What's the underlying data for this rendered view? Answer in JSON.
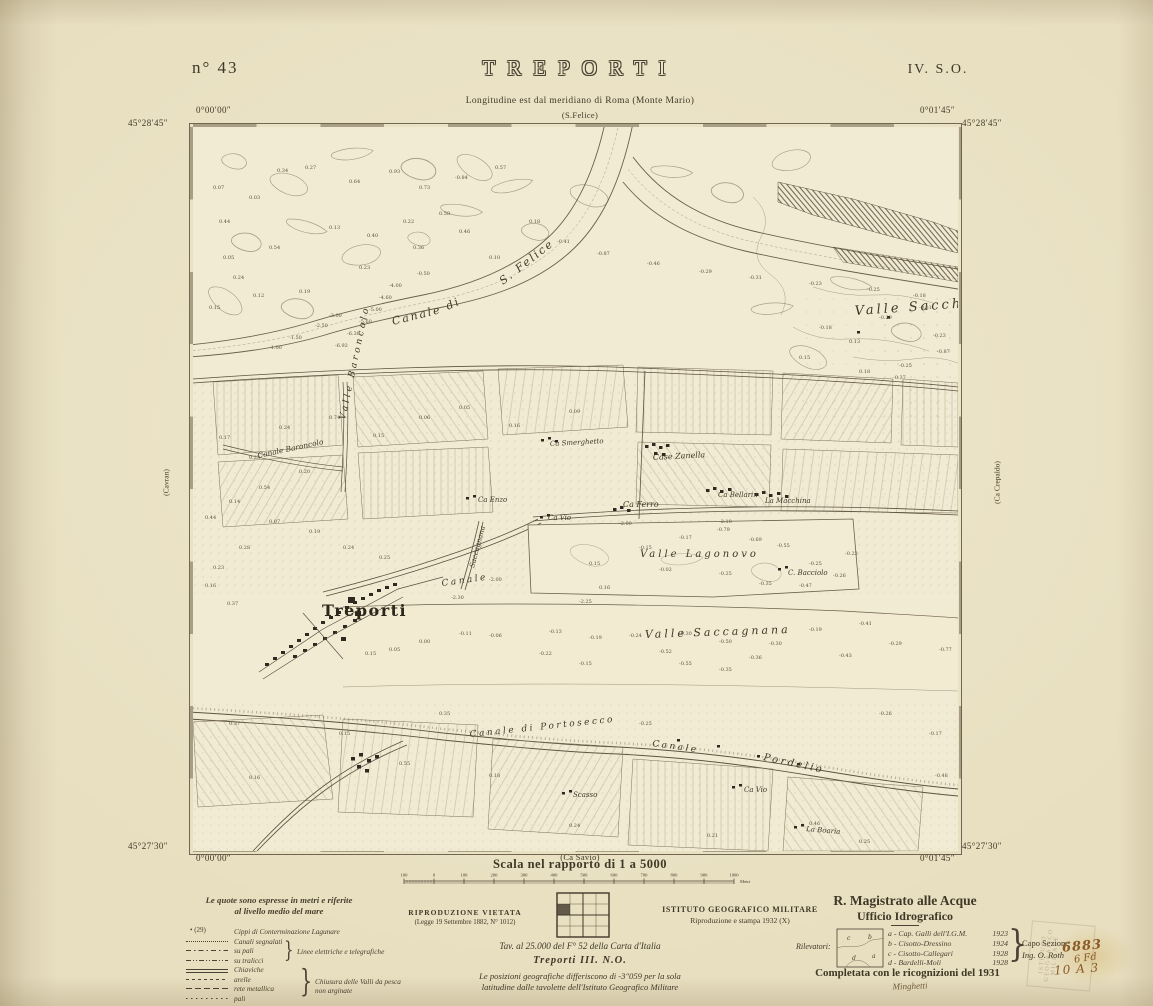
{
  "header": {
    "sheet_no": "n° 43",
    "title": "TREPORTI",
    "quadrant": "IV. S.O.",
    "subtitle": "Longitudine est dal meridiano di Roma (Monte Mario)",
    "adjacent_top": "(S.Felice)",
    "adjacent_bottom": "(Ca Savio)",
    "adjacent_left": "(Cavran)",
    "adjacent_right": "(Ca Crepaldo)"
  },
  "corners": {
    "top_lat": "45°28′45″",
    "bottom_lat": "45°27′30″",
    "top_left_lon": "0°00′00″",
    "top_right_lon": "0°01′45″",
    "bottom_left_lon": "0°00′00″",
    "bottom_right_lon": "0°01′45″"
  },
  "scale": {
    "caption": "Scala nel rapporto di 1 a 5000",
    "bar_labels": [
      "100",
      "0",
      "100",
      "200",
      "300",
      "400",
      "500",
      "600",
      "700",
      "800",
      "900",
      "1000"
    ],
    "unit": "Metri"
  },
  "legend": {
    "title_line1": "Le quote sono espresse in metri e riferite",
    "title_line2": "al livello medio del mare",
    "cippi_symbol": "• (29)",
    "items": [
      {
        "sample": "symtext",
        "label": "Cippi di Conterminazione Lagunare"
      },
      {
        "sample": "dotted",
        "label": "Canali segnalati"
      },
      {
        "sample": "dashdot",
        "label": "su pali"
      },
      {
        "sample": "dashdotdot",
        "label": "su tralicci"
      },
      {
        "sample": "double",
        "label": "Chiaviche"
      },
      {
        "sample": "dash",
        "label": "arelle"
      },
      {
        "sample": "longdash",
        "label": "rete metallica"
      },
      {
        "sample": "pali",
        "label": "pali"
      }
    ],
    "group1_label": "Linee elettriche e telegrafiche",
    "group2_line1": "Chiusura delle Valli da pesca",
    "group2_line2": "non arginate"
  },
  "imprint": {
    "repro_line1": "RIPRODUZIONE VIETATA",
    "repro_line2": "(Legge 19 Settembre 1882, N° 1012)",
    "tav_line": "Tav. al 25.000 del F° 52 della Carta d'Italia",
    "tav_sheet": "Treporti III. N.O.",
    "note_line1": "Le posizioni geografiche differiscono di -3″059 per la sola",
    "note_line2": "latitudine dalle tavolette dell'Istituto Geografico Militare",
    "igm_line1": "ISTITUTO GEOGRAFICO MILITARE",
    "igm_line2": "Riproduzione e stampa 1932 (X)"
  },
  "agency": {
    "line1": "R. Magistrato alle Acque",
    "line2": "Ufficio Idrografico",
    "rilevatori_label": "Rilevatori:",
    "rilevatori": [
      {
        "key": "a",
        "name": "a - Cap. Galli dell'I.G.M.",
        "year": "1923"
      },
      {
        "key": "b",
        "name": "b - Cisotto-Dressino",
        "year": "1924"
      },
      {
        "key": "c",
        "name": "c - Cisotto-Callegari",
        "year": "1928"
      },
      {
        "key": "d",
        "name": "d - Bardelli-Moli",
        "year": "1928"
      }
    ],
    "capo_line1": "Capo Sezione",
    "capo_line2": "Ing. O. Roth",
    "completata_line": "Completata con le ricognizioni del 1931",
    "signature": "Minghetti"
  },
  "annotations": {
    "stamp_lines": [
      "ISTITUTO",
      "GEOGRAFICO",
      "MILITARE"
    ],
    "handwritten": [
      "6883",
      "6 Fd",
      "10 A 3"
    ]
  },
  "map": {
    "labels": [
      {
        "t": "Canale",
        "x": 200,
        "y": 198,
        "r": -14,
        "s": 11,
        "c": "canal"
      },
      {
        "t": "di",
        "x": 255,
        "y": 183,
        "r": -25,
        "s": 11,
        "c": "canal"
      },
      {
        "t": "S. Felice",
        "x": 310,
        "y": 158,
        "r": -38,
        "s": 11,
        "c": "canal"
      },
      {
        "t": "Valle Sacchetta",
        "x": 662,
        "y": 188,
        "r": -4,
        "s": 13,
        "c": "place"
      },
      {
        "t": "Valle Baroncolo",
        "x": 152,
        "y": 293,
        "r": -78,
        "s": 9,
        "c": "place"
      },
      {
        "t": "Canale Baroncolo",
        "x": 65,
        "y": 331,
        "r": -12,
        "s": 7.5,
        "c": "it"
      },
      {
        "t": "Ca Smerghetto",
        "x": 357,
        "y": 319,
        "r": -3,
        "s": 7,
        "c": "it"
      },
      {
        "t": "Case Zanella",
        "x": 460,
        "y": 333,
        "r": -3,
        "s": 8,
        "c": "it"
      },
      {
        "t": "Ca Enzo",
        "x": 285,
        "y": 375,
        "r": 0,
        "s": 7,
        "c": "it"
      },
      {
        "t": "Ca Ferro",
        "x": 430,
        "y": 380,
        "r": 0,
        "s": 8,
        "c": "it"
      },
      {
        "t": "Ca Vio",
        "x": 355,
        "y": 393,
        "r": 0,
        "s": 7,
        "c": "it"
      },
      {
        "t": "Ca Bellarin",
        "x": 525,
        "y": 370,
        "r": 0,
        "s": 7,
        "c": "it"
      },
      {
        "t": "La Macchina",
        "x": 572,
        "y": 376,
        "r": 0,
        "s": 7,
        "c": "it"
      },
      {
        "t": "Valle Lagonovo",
        "x": 447,
        "y": 430,
        "r": 0,
        "s": 10,
        "c": "place"
      },
      {
        "t": "C. Bacciolo",
        "x": 595,
        "y": 448,
        "r": 0,
        "s": 7,
        "c": "it"
      },
      {
        "t": "Treporti",
        "x": 129,
        "y": 489,
        "r": 0,
        "s": 16,
        "c": "town"
      },
      {
        "t": "Canale",
        "x": 249,
        "y": 459,
        "r": -8,
        "s": 9,
        "c": "canal2"
      },
      {
        "t": "Saccagnana",
        "x": 281,
        "y": 441,
        "r": -75,
        "s": 7,
        "c": "it"
      },
      {
        "t": "Valle Saccagnana",
        "x": 452,
        "y": 511,
        "r": -2,
        "s": 11,
        "c": "place"
      },
      {
        "t": "Canale di Portosecco",
        "x": 277,
        "y": 610,
        "r": -6,
        "s": 9,
        "c": "canal2"
      },
      {
        "t": "Canale",
        "x": 459,
        "y": 619,
        "r": 8,
        "s": 9,
        "c": "canal2"
      },
      {
        "t": "Pordelio",
        "x": 570,
        "y": 633,
        "r": 12,
        "s": 10,
        "c": "canal2"
      },
      {
        "t": "Scasso",
        "x": 380,
        "y": 670,
        "r": 0,
        "s": 7,
        "c": "it"
      },
      {
        "t": "Ca Vio",
        "x": 551,
        "y": 665,
        "r": 0,
        "s": 7,
        "c": "it"
      },
      {
        "t": "La Boaria",
        "x": 613,
        "y": 704,
        "r": 5,
        "s": 7,
        "c": "it"
      }
    ],
    "soundings": [
      {
        "v": "0.27",
        "x": 112,
        "y": 42
      },
      {
        "v": "0.64",
        "x": 156,
        "y": 56
      },
      {
        "v": "0.93",
        "x": 196,
        "y": 46
      },
      {
        "v": "0.73",
        "x": 226,
        "y": 62
      },
      {
        "v": "-0.84",
        "x": 262,
        "y": 52
      },
      {
        "v": "0.57",
        "x": 302,
        "y": 42
      },
      {
        "v": "0.03",
        "x": 56,
        "y": 72
      },
      {
        "v": "0.44",
        "x": 26,
        "y": 96
      },
      {
        "v": "0.54",
        "x": 76,
        "y": 122
      },
      {
        "v": "0.24",
        "x": 40,
        "y": 152
      },
      {
        "v": "0.19",
        "x": 106,
        "y": 166
      },
      {
        "v": "0.15",
        "x": 16,
        "y": 182
      },
      {
        "v": "0.23",
        "x": 166,
        "y": 142
      },
      {
        "v": "0.36",
        "x": 220,
        "y": 122
      },
      {
        "v": "0.46",
        "x": 266,
        "y": 106
      },
      {
        "v": "0.10",
        "x": 296,
        "y": 132
      },
      {
        "v": "0.18",
        "x": 336,
        "y": 96
      },
      {
        "v": "0.07",
        "x": 20,
        "y": 62
      },
      {
        "v": "0.05",
        "x": 30,
        "y": 132
      },
      {
        "v": "0.13",
        "x": 136,
        "y": 102
      },
      {
        "v": "0.34",
        "x": 84,
        "y": 45
      },
      {
        "v": "0.58",
        "x": 246,
        "y": 88
      },
      {
        "v": "0.22",
        "x": 210,
        "y": 96
      },
      {
        "v": "0.40",
        "x": 174,
        "y": 110
      },
      {
        "v": "0.12",
        "x": 60,
        "y": 170
      },
      {
        "v": "-4.00",
        "x": 196,
        "y": 160
      },
      {
        "v": "-4.60",
        "x": 186,
        "y": 172
      },
      {
        "v": "-5.00",
        "x": 176,
        "y": 184
      },
      {
        "v": "-5.60",
        "x": 166,
        "y": 196
      },
      {
        "v": "-6.30",
        "x": 154,
        "y": 208
      },
      {
        "v": "-6.92",
        "x": 142,
        "y": 220
      },
      {
        "v": "-1.50",
        "x": 96,
        "y": 212
      },
      {
        "v": "-1.00",
        "x": 76,
        "y": 222
      },
      {
        "v": "-2.50",
        "x": 122,
        "y": 200
      },
      {
        "v": "-3.00",
        "x": 136,
        "y": 190
      },
      {
        "v": "-0.50",
        "x": 224,
        "y": 148
      },
      {
        "v": "-0.87",
        "x": 404,
        "y": 128
      },
      {
        "v": "-0.46",
        "x": 454,
        "y": 138
      },
      {
        "v": "-0.29",
        "x": 506,
        "y": 146
      },
      {
        "v": "-0.31",
        "x": 556,
        "y": 152
      },
      {
        "v": "-0.23",
        "x": 616,
        "y": 158
      },
      {
        "v": "-0.25",
        "x": 674,
        "y": 164
      },
      {
        "v": "-0.18",
        "x": 720,
        "y": 170
      },
      {
        "v": "-0.41",
        "x": 364,
        "y": 116
      },
      {
        "v": "-0.18",
        "x": 626,
        "y": 202
      },
      {
        "v": "0.13",
        "x": 656,
        "y": 216
      },
      {
        "v": "-0.29",
        "x": 686,
        "y": 192
      },
      {
        "v": "-0.31",
        "x": 726,
        "y": 182
      },
      {
        "v": "-0.87",
        "x": 744,
        "y": 226
      },
      {
        "v": "-0.25",
        "x": 706,
        "y": 240
      },
      {
        "v": "0.15",
        "x": 606,
        "y": 232
      },
      {
        "v": "0.18",
        "x": 666,
        "y": 246
      },
      {
        "v": "-0.37",
        "x": 700,
        "y": 252
      },
      {
        "v": "-0.23",
        "x": 740,
        "y": 210
      },
      {
        "v": "0.74",
        "x": 136,
        "y": 292
      },
      {
        "v": "0.24",
        "x": 86,
        "y": 302
      },
      {
        "v": "0.17",
        "x": 26,
        "y": 312
      },
      {
        "v": "0.23",
        "x": 56,
        "y": 332
      },
      {
        "v": "0.20",
        "x": 106,
        "y": 346
      },
      {
        "v": "0.54",
        "x": 66,
        "y": 362
      },
      {
        "v": "0.14",
        "x": 36,
        "y": 376
      },
      {
        "v": "0.44",
        "x": 12,
        "y": 392
      },
      {
        "v": "0.07",
        "x": 76,
        "y": 396
      },
      {
        "v": "0.19",
        "x": 116,
        "y": 406
      },
      {
        "v": "0.24",
        "x": 150,
        "y": 422
      },
      {
        "v": "0.25",
        "x": 186,
        "y": 432
      },
      {
        "v": "0.28",
        "x": 46,
        "y": 422
      },
      {
        "v": "0.23",
        "x": 20,
        "y": 442
      },
      {
        "v": "0.16",
        "x": 12,
        "y": 460
      },
      {
        "v": "0.37",
        "x": 34,
        "y": 478
      },
      {
        "v": "0.16",
        "x": 316,
        "y": 300
      },
      {
        "v": "0.05",
        "x": 266,
        "y": 282
      },
      {
        "v": "0.06",
        "x": 226,
        "y": 292
      },
      {
        "v": "0.15",
        "x": 180,
        "y": 310
      },
      {
        "v": "0.09",
        "x": 376,
        "y": 286
      },
      {
        "v": "-0.17",
        "x": 486,
        "y": 412
      },
      {
        "v": "-0.69",
        "x": 556,
        "y": 414
      },
      {
        "v": "-0.15",
        "x": 446,
        "y": 422
      },
      {
        "v": "-0.25",
        "x": 616,
        "y": 438
      },
      {
        "v": "-0.22",
        "x": 652,
        "y": 428
      },
      {
        "v": "-0.02",
        "x": 466,
        "y": 444
      },
      {
        "v": "-0.25",
        "x": 526,
        "y": 448
      },
      {
        "v": "-0.26",
        "x": 640,
        "y": 450
      },
      {
        "v": "-0.35",
        "x": 566,
        "y": 458
      },
      {
        "v": "-0.47",
        "x": 606,
        "y": 460
      },
      {
        "v": "0.15",
        "x": 396,
        "y": 438
      },
      {
        "v": "0.16",
        "x": 406,
        "y": 462
      },
      {
        "v": "-0.79",
        "x": 524,
        "y": 404
      },
      {
        "v": "-0.55",
        "x": 584,
        "y": 420
      },
      {
        "v": "-2.00",
        "x": 426,
        "y": 398
      },
      {
        "v": "-2.10",
        "x": 526,
        "y": 396
      },
      {
        "v": "-2.25",
        "x": 386,
        "y": 476
      },
      {
        "v": "-2.00",
        "x": 296,
        "y": 454
      },
      {
        "v": "-2.30",
        "x": 258,
        "y": 472
      },
      {
        "v": "-0.11",
        "x": 266,
        "y": 508
      },
      {
        "v": "-0.06",
        "x": 296,
        "y": 510
      },
      {
        "v": "-0.13",
        "x": 356,
        "y": 506
      },
      {
        "v": "-0.19",
        "x": 396,
        "y": 512
      },
      {
        "v": "-0.24",
        "x": 436,
        "y": 510
      },
      {
        "v": "-0.30",
        "x": 486,
        "y": 508
      },
      {
        "v": "-0.50",
        "x": 526,
        "y": 516
      },
      {
        "v": "-0.52",
        "x": 466,
        "y": 526
      },
      {
        "v": "-0.30",
        "x": 576,
        "y": 518
      },
      {
        "v": "-0.19",
        "x": 616,
        "y": 504
      },
      {
        "v": "-0.41",
        "x": 666,
        "y": 498
      },
      {
        "v": "-0.29",
        "x": 696,
        "y": 518
      },
      {
        "v": "-0.35",
        "x": 526,
        "y": 544
      },
      {
        "v": "-0.55",
        "x": 486,
        "y": 538
      },
      {
        "v": "-0.77",
        "x": 746,
        "y": 524
      },
      {
        "v": "-0.15",
        "x": 386,
        "y": 538
      },
      {
        "v": "-0.22",
        "x": 346,
        "y": 528
      },
      {
        "v": "0.00",
        "x": 226,
        "y": 516
      },
      {
        "v": "0.05",
        "x": 196,
        "y": 524
      },
      {
        "v": "0.15",
        "x": 172,
        "y": 528
      },
      {
        "v": "-0.36",
        "x": 556,
        "y": 532
      },
      {
        "v": "-0.43",
        "x": 646,
        "y": 530
      },
      {
        "v": "0.35",
        "x": 246,
        "y": 588
      },
      {
        "v": "0.15",
        "x": 146,
        "y": 608
      },
      {
        "v": "0.55",
        "x": 206,
        "y": 638
      },
      {
        "v": "0.37",
        "x": 36,
        "y": 598
      },
      {
        "v": "0.16",
        "x": 56,
        "y": 652
      },
      {
        "v": "-0.25",
        "x": 446,
        "y": 598
      },
      {
        "v": "0.46",
        "x": 616,
        "y": 698
      },
      {
        "v": "0.25",
        "x": 666,
        "y": 716
      },
      {
        "v": "-0.17",
        "x": 736,
        "y": 608
      },
      {
        "v": "-0.26",
        "x": 686,
        "y": 588
      },
      {
        "v": "0.18",
        "x": 296,
        "y": 650
      },
      {
        "v": "0.24",
        "x": 376,
        "y": 700
      },
      {
        "v": "0.21",
        "x": 514,
        "y": 710
      },
      {
        "v": "-0.48",
        "x": 742,
        "y": 650
      }
    ]
  }
}
